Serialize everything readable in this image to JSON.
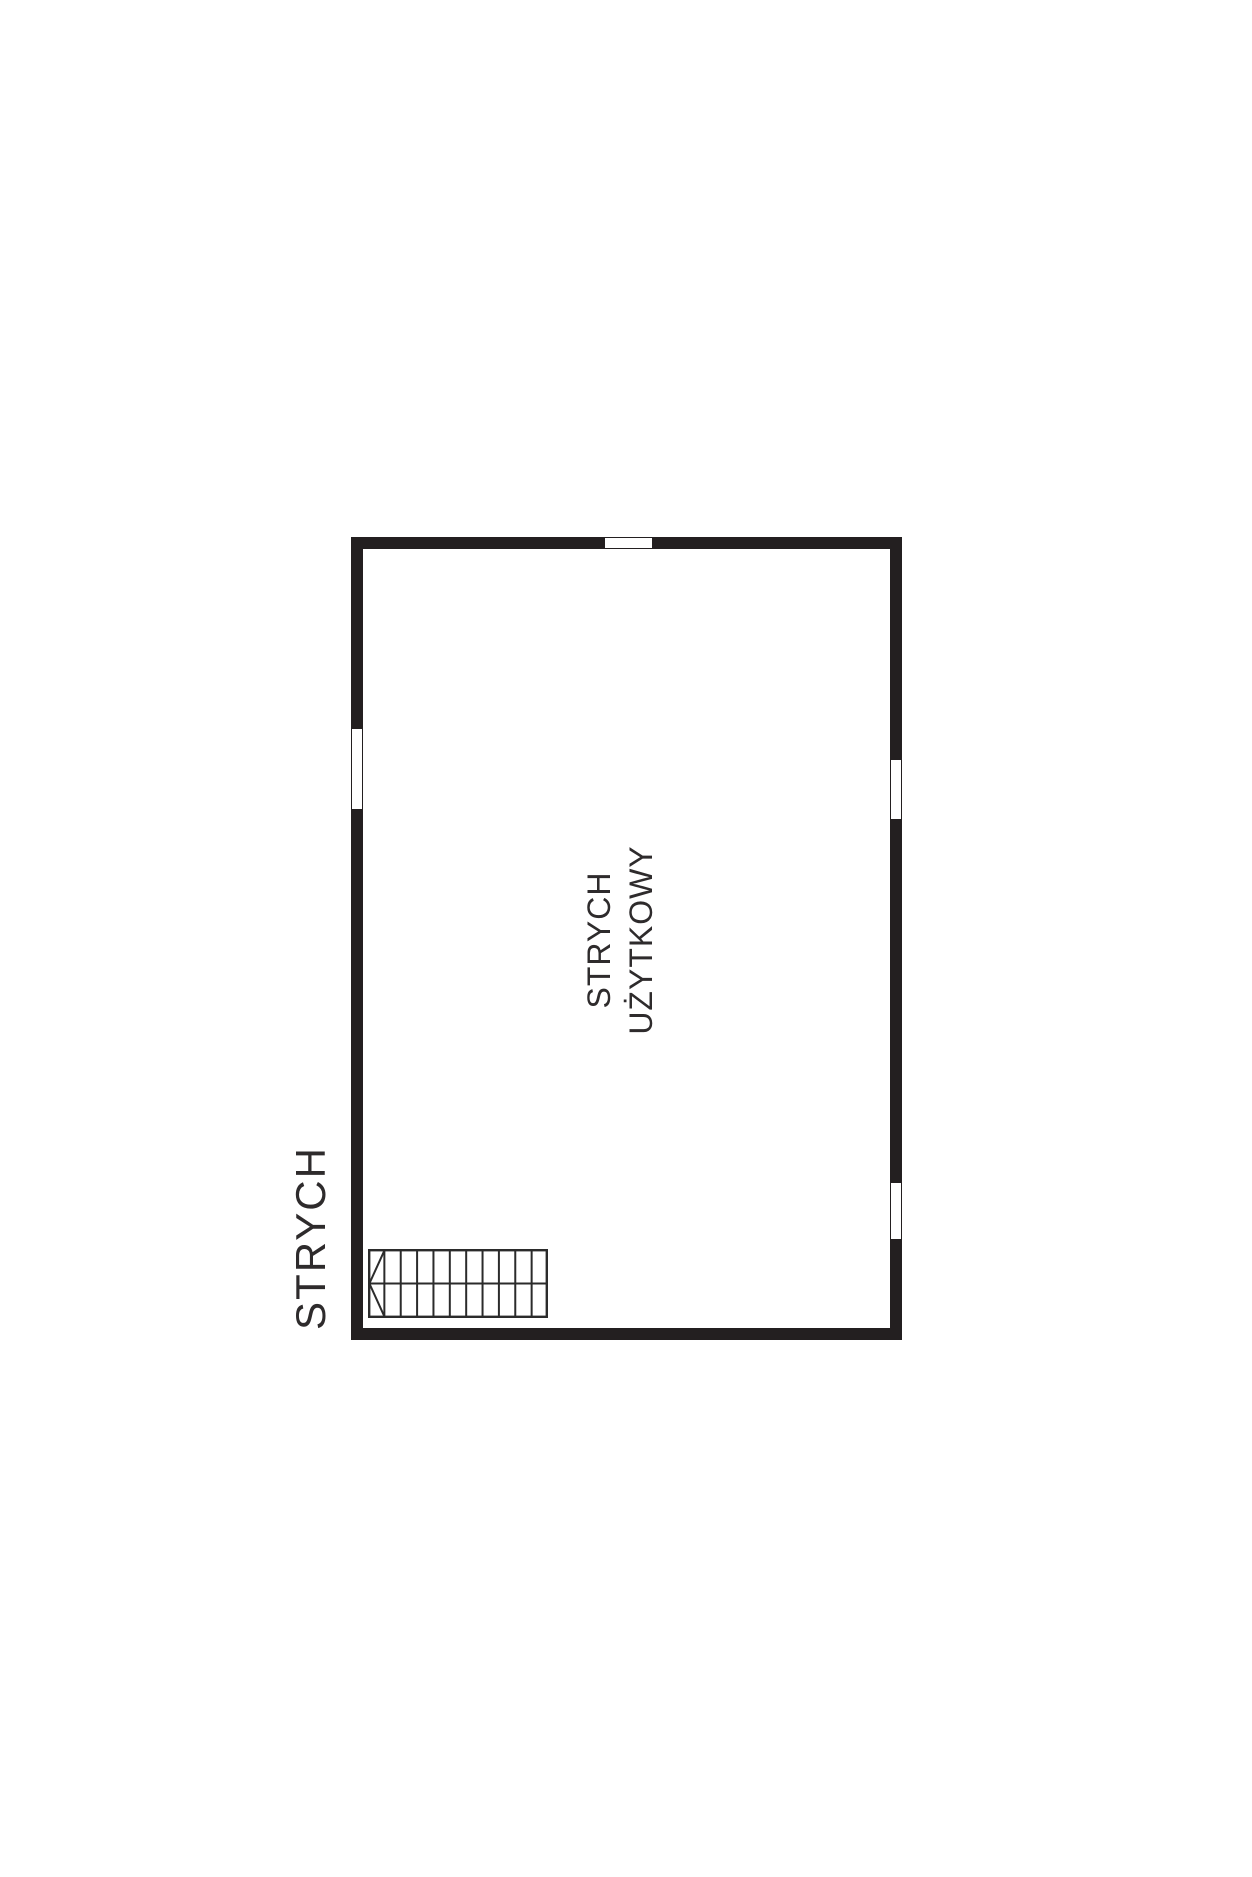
{
  "floor_label": "STRYCH",
  "room": {
    "name_line1": "STRYCH",
    "name_line2": "UŻYTKOWY"
  },
  "colors": {
    "wall": "#231f20",
    "line": "#2b2b2b",
    "text": "#2e2b2c",
    "background": "#ffffff"
  },
  "plan": {
    "outer": {
      "x": 351,
      "y": 537,
      "width": 551,
      "height": 803
    },
    "wall_thickness": 12,
    "windows": [
      {
        "id": "window-top",
        "wall": "top",
        "x": 604,
        "y": 537,
        "width": 49,
        "height": 12
      },
      {
        "id": "window-left",
        "wall": "left",
        "x": 351,
        "y": 728,
        "width": 12,
        "height": 82
      },
      {
        "id": "window-right-upper",
        "wall": "right",
        "x": 890,
        "y": 759,
        "width": 12,
        "height": 61
      },
      {
        "id": "window-right-lower",
        "wall": "right",
        "x": 890,
        "y": 1182,
        "width": 12,
        "height": 58
      }
    ],
    "stairs": {
      "x": 368,
      "y": 1249,
      "width": 180,
      "height": 69,
      "columns": 11,
      "rows": 2,
      "direction_marker": "left-chevron"
    }
  }
}
